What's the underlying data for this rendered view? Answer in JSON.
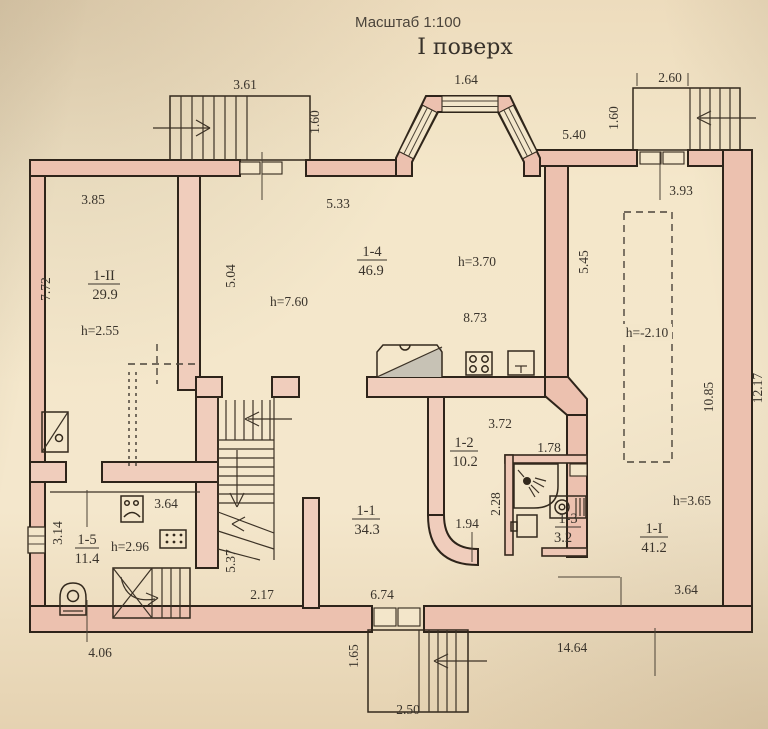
{
  "title": {
    "scale": "Масштаб 1:100",
    "floor": "I поверх"
  },
  "rooms": [
    {
      "id": "1-II",
      "area": "29.9",
      "height": "h=2.55"
    },
    {
      "id": "1-4",
      "area": "46.9",
      "height": "h=7.60"
    },
    {
      "id": "1-2",
      "area": "10.2"
    },
    {
      "id": "1-3",
      "area": "3.2"
    },
    {
      "id": "1-1",
      "area": "34.3"
    },
    {
      "id": "1-5",
      "area": "11.4",
      "height": "h=2.96"
    },
    {
      "id": "1-I",
      "area": "41.2",
      "height": "h=3.65"
    }
  ],
  "annotations": {
    "kitchen_height": "h=3.70",
    "kitchen_width": "8.73",
    "shaft_height": "h=-2.10"
  },
  "dimensions": {
    "stair_tl_width": "3.61",
    "stair_tl_depth": "1.60",
    "bay_width": "1.64",
    "top_right_wall": "5.40",
    "stair_tr_width": "2.60",
    "stair_tr_depth": "1.60",
    "room_right_top": "3.93",
    "room_1II_width": "3.85",
    "room_1II_depth": "7.72",
    "room_14_width": "5.33",
    "room_14_depth": "5.04",
    "right_wall_upper": "5.45",
    "right_wall_lower": "10.85",
    "right_wall_outer": "12.17",
    "room_12_width": "3.72",
    "bath_width": "1.78",
    "bath_depth": "2.28",
    "room_12_lower": "1.94",
    "stair_hall_depth": "5.37",
    "bottom_span_1": "2.17",
    "bottom_span_2": "6.74",
    "room_15_width": "3.64",
    "room_15_depth": "3.14",
    "room_1I_bottom": "3.64",
    "bottom_left_span": "4.06",
    "stair_bottom_depth": "1.65",
    "stair_bottom_width": "2.50",
    "bottom_right_span": "14.64"
  },
  "colors": {
    "wall_fill": "#ecc1af",
    "line": "#33291d",
    "paper": "#f3e6ca"
  }
}
